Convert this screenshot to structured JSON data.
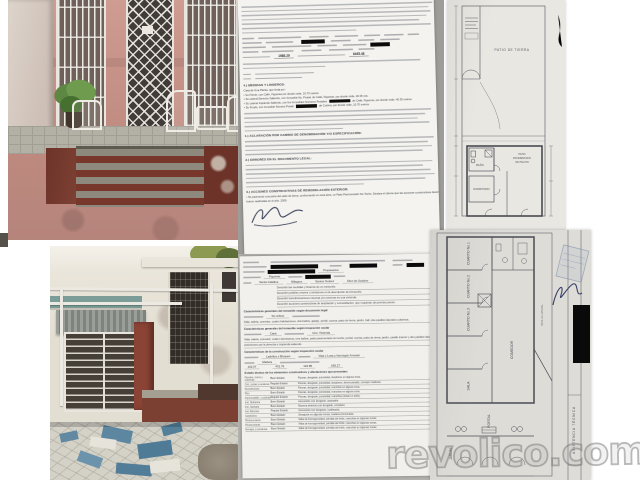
{
  "watermark": {
    "text": "revolico.com"
  },
  "doc1": {
    "price1": "1988.29",
    "price2": "6465.48",
    "sec4": "4.) MEDIDAS Y LINDEROS:",
    "linderos": [
      {
        "pre": "Casa de Una Planta, que linda por:"
      },
      {
        "pre": "• Su Frente, con Calle, Figueras por donde mide, 10.70 metros."
      },
      {
        "pre": "• Su Lateral Derecho Saliendo, con Inmueble No. Postal, de Calle, Figueras, por donde mide, 40.35 mts."
      },
      {
        "pre": "• Su Lateral Izquierdo Saliendo, con los Inmuebles Números Postales",
        "redact": true,
        "post": "de Calle, Figueras, por donde mide, 40.35 metros."
      },
      {
        "pre": "• Su Fondo, con Inmueble Número Postal",
        "redact": true,
        "post": "de Cortina, por donde mide, 10.70 metros."
      }
    ],
    "sec1": "1.) ACLARACIÓN POR CAMBIO DE DENOMINACIÓN Y/O ESPECIFICACIÓN:",
    "sec2": "2.) ERRORES EN EL DOCUMENTO LEGAL:",
    "sec3": "3.) ACCIONES CONSTRUCTIVAS DE REMODELACIÓN EXTERIOR:",
    "remodel_line": "• Se pavimentó una parte del patio de tierra, conformando en esta área, un Patio Pavimentado Sin Techo. Declara el cliente que las acciones constructivas descritas fueron realizadas en el año: 2009."
  },
  "doc2": {
    "owner": "Propietarios",
    "street": "Figueras",
    "between_a": "Santa Catalina",
    "between_b": "Milagros",
    "reparto": "Santos Suárez",
    "municipio": "Diez de Octubre",
    "describe_lines": [
      "Describir las medidas y linderos de un inmueble.",
      "Describir posibles errores u omisiones en la descripción del inmueble.",
      "Describir transformaciones internas y/o externas en una vivienda.",
      "Describir acciones constructivas de ampliación y consolidación, que requieran de permiso previo."
    ],
    "sec5_heading": "Características generales del inmueble según documento legal",
    "sec5_tipo": "No refiere",
    "sec5_year": "1940",
    "sec5_dist": "Sala, saleta, comedor, cuatro habitaciones, dos baños, garaje, portal, cocina, patio de tierra, jardín, hall, dos pasillos laterales cubiertos.",
    "sec6_heading": "Características generales del inmueble según inspección ocular",
    "sec6_tipo": "Casa",
    "sec6_uso": "Uso: Vivienda",
    "sec6_year": "1940",
    "sec6_dist": "Sala, saleta, comedor, cuatro dormitorios, tres baños, patio pavimentado sin techo, portal, cocina, patio de tierra, jardín, pasillo interior y dos pasillos laterales posteriores por la derecha e izquierda saliendo.",
    "sec7_heading": "Características de la construcción según inspección ocular",
    "sec7_muros": "Ladrillos y Bloques",
    "sec7_cubierta": "Viga y Losa y Hormigón Armado",
    "sec7_otros": "Madera",
    "sec7_areas": [
      "102.07",
      "431.76",
      "122.86",
      "636.27"
    ],
    "sec8_heading": "Estado técnico de los elementos constructivos y afectaciones que presentan:",
    "estado_rows": [
      {
        "el": "Paredes, muros y columnas",
        "estado": "Buen Estado",
        "desc": "Fisuras, desgaste, porosidad, desplome en alguna zona."
      },
      {
        "el": "Cub., juntas y escaleras",
        "estado": "Regular Estado",
        "desc": "Fisuras, desgaste, porosidad, desplome, desencantado, comején maderas."
      },
      {
        "el": "Revestimiento",
        "estado": "Buen Estado",
        "desc": "Fisuras, desgaste, porosidad, manchas en alguna zona."
      },
      {
        "el": "Piso",
        "estado": "Buen Estado",
        "desc": "Fisuras, desgaste, porosidad, manchas en alguna zona."
      },
      {
        "el": "Impermeabiliz. y cubierta",
        "estado": "Regular Estado",
        "desc": "Fisuras, desgaste, porosidad, manchas (vistas en sello)."
      },
      {
        "el": "Inst. Hidráulica",
        "estado": "Buen Estado",
        "desc": "Accesorios con desgaste, aceptable."
      },
      {
        "el": "Inst. Sanitaria",
        "estado": "Buen Estado",
        "desc": "Muestra deterioro por desgaste, completo."
      },
      {
        "el": "Inst. Eléctrica",
        "estado": "Regular Estado",
        "desc": "Accesorios con desgaste, (cableado)."
      },
      {
        "el": "Carpintería",
        "estado": "Buen Estado",
        "desc": "Desajuste en algunas zonas, madera conservada."
      },
      {
        "el": "Pintura exterior",
        "estado": "Buen Estado",
        "desc": "Falta de homogeneidad, pérdida del brillo, manchas en algunas zonas."
      },
      {
        "el": "Pintura interior",
        "estado": "Buen Estado",
        "desc": "Falta de homogeneidad, pérdida del brillo, manchas en algunas zonas."
      },
      {
        "el": "Herrajes y cerraduras",
        "estado": "Buen Estado",
        "desc": "Falta de homogeneidad, pérdida del brillo, manchas en algunas zonas."
      }
    ]
  },
  "plan1": {
    "labels": {
      "patio": "PATIO DE TIERRA",
      "pav1": "PATIO",
      "pav2": "PAVIMENTADO",
      "pav3": "SIN TECHO",
      "dormitorio": "DORMITORIO",
      "bano": "BAÑO"
    }
  },
  "plan2": {
    "rooms": [
      "CUARTO No.1",
      "CUARTO No.2",
      "CUARTO No.3",
      "SALA",
      "COMEDOR",
      "PORTAL",
      "JARDÍN"
    ],
    "pasillo": "PASILLO LATERAL",
    "titleblock": "ASISTENCIA TÉCNICA"
  }
}
